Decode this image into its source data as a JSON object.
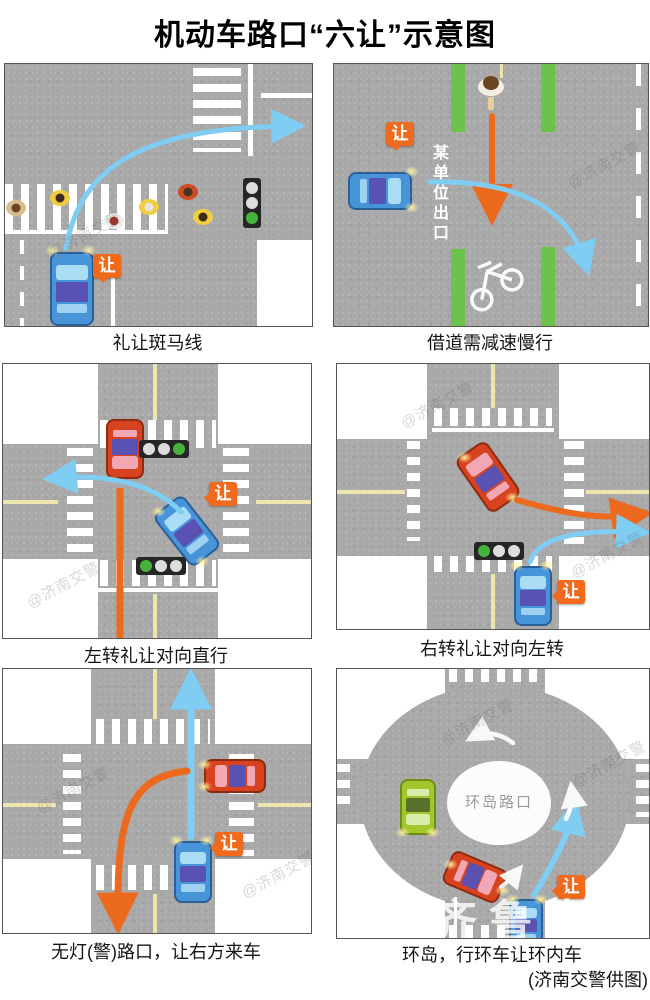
{
  "title": "机动车路口“六让”示意图",
  "credit": "(济南交警供图)",
  "yield_label": "让",
  "watermark_text": "@济南交警",
  "qilu_watermark": "齐鲁壹点",
  "colors": {
    "yield_badge": "#f06a1e",
    "yield_path_arrow": "#7fcdf2",
    "priority_arrow": "#ec6a1e",
    "bike_lane_green": "#6cc24a",
    "road_gray": "#a9a9a9",
    "go_light_green": "#46b43c"
  },
  "panels": [
    {
      "caption": "礼让斑马线",
      "vehicles": [
        "blue-car"
      ],
      "signals": [
        "green-traffic-light"
      ]
    },
    {
      "caption": "借道需减速慢行",
      "exit_sign": "某单位出口",
      "vehicles": [
        "blue-car"
      ],
      "signals": []
    },
    {
      "caption": "左转礼让对向直行",
      "vehicles": [
        "red-car",
        "blue-car"
      ],
      "signals": [
        "green-traffic-light",
        "green-traffic-light"
      ]
    },
    {
      "caption": "右转礼让对向左转",
      "vehicles": [
        "red-car",
        "blue-car"
      ],
      "signals": [
        "green-traffic-light"
      ]
    },
    {
      "caption": "无灯(警)路口，让右方来车",
      "vehicles": [
        "red-car",
        "blue-car"
      ],
      "signals": []
    },
    {
      "caption": "环岛，行环车让环内车",
      "island_label": "环岛路口",
      "vehicles": [
        "green-car",
        "red-car",
        "blue-car"
      ],
      "signals": []
    }
  ]
}
